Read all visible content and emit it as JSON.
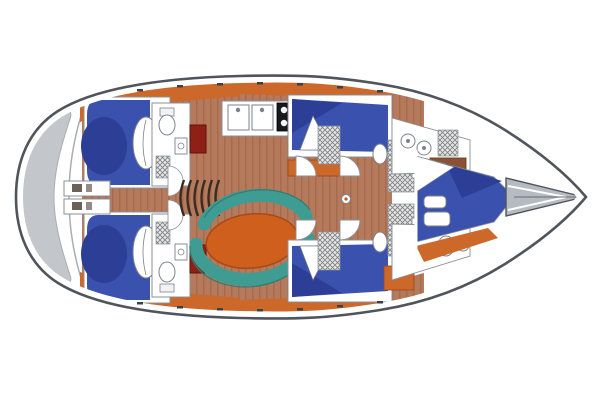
{
  "diagram": {
    "type": "yacht-interior-deck-plan",
    "orientation": "bow-right-stern-left",
    "regions": [
      "stern-swim-platform",
      "aft-cabin-port",
      "aft-cabin-starboard",
      "aft-head-port",
      "aft-head-starboard",
      "companionway-steps",
      "galley",
      "salon-settee",
      "salon-table",
      "mid-cabin-port",
      "mid-cabin-starboard",
      "mid-head-shower",
      "corridor",
      "forward-head",
      "forward-v-berth-cabin",
      "bow-anchor-locker"
    ],
    "fixtures": [
      "double-berth",
      "pillow",
      "toilet",
      "sink",
      "stove-4-burner",
      "door-swing",
      "steps",
      "mast-foot",
      "locker",
      "shelf",
      "hull-ports"
    ]
  },
  "palette": {
    "hull_outline": "#50555b",
    "deck_white": "#ffffff",
    "room_stroke": "#8b9096",
    "platform_gray": "#c3c6cb",
    "platform_shade": "#a9adb4",
    "berth_blue": "#3a52ae",
    "berth_navy": "#2c3e96",
    "floor_brown": "#b5795c",
    "floor_grain": "#9c5d42",
    "orange": "#cc6829",
    "dark_orange": "#c05a1d",
    "table_orange": "#cf5f1c",
    "teal": "#3f9c92",
    "teal_dark": "#2e7d75",
    "door_red": "#8f2015",
    "stove_black": "#17191c",
    "hatch_bg": "#e9e6dc",
    "hatch_line": "#77808f",
    "green_locker": "#2f7e6b",
    "shelf_brown": "#8a5134",
    "bow_gray": "#b6bac1",
    "fixture_line": "#7c828c",
    "step_dark": "#3a2c20",
    "port_dark": "#3c4148"
  }
}
